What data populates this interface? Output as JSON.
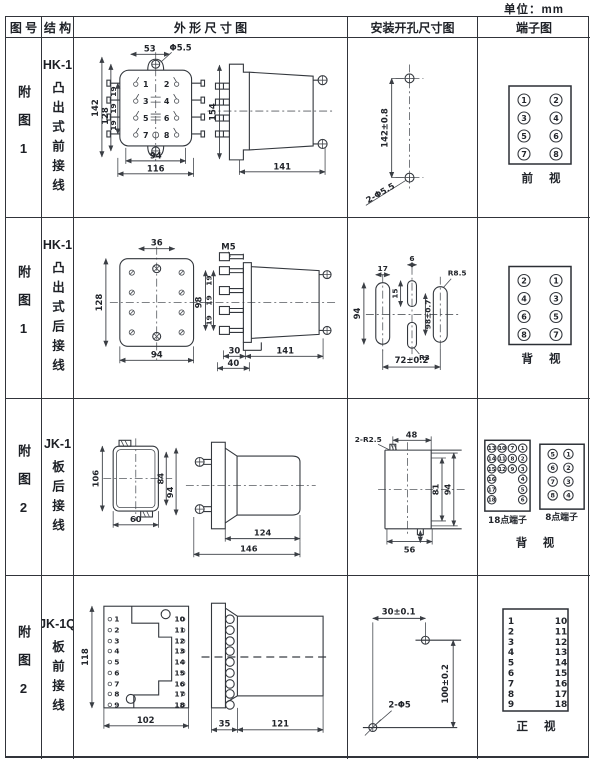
{
  "page": {
    "unit_label": "单位：mm"
  },
  "headers": {
    "fig_no": "图 号",
    "structure": "结 构",
    "outline": "外 形 尺 寸 图",
    "mounting": "安装开孔尺寸图",
    "terminal": "端子图"
  },
  "rows": [
    {
      "fig_label": "附图1",
      "model": "HK-1",
      "wiring": "凸出式前接线",
      "outline": {
        "top_width": "53",
        "hole_dia": "Φ5.5",
        "height_outer": "142",
        "height_inner": "128",
        "pitch1": "19",
        "pitch2": "19",
        "pitch3": "19",
        "bottom_inner": "94",
        "bottom_outer": "116",
        "side_height": "154",
        "side_depth": "141",
        "pins": [
          "1",
          "2",
          "3",
          "4",
          "5",
          "6",
          "7",
          "8"
        ]
      },
      "mounting": {
        "hole_pitch": "142±0.8",
        "holes": "2-Φ5.5"
      },
      "terminal": {
        "left": [
          "1",
          "3",
          "5",
          "7"
        ],
        "right": [
          "2",
          "4",
          "6",
          "8"
        ],
        "view_label": "前 视"
      }
    },
    {
      "fig_label": "附图1",
      "model": "HK-1",
      "wiring": "凸出式后接线",
      "outline": {
        "top_width": "36",
        "height": "128",
        "bottom_width": "94",
        "thread": "M5",
        "stud_span": "98",
        "pitch1": "19",
        "pitch2": "19",
        "pitch3": "19",
        "foot1": "30",
        "foot2": "40",
        "side_depth": "141"
      },
      "mounting": {
        "slot_w": "17",
        "mid_slot_w": "6",
        "mid_slot_h": "15",
        "slot_h": "94",
        "mid_pitch": "98±0.7",
        "radius_big": "R8.5",
        "radius_small": "R3",
        "h_pitch": "72±0.2"
      },
      "terminal": {
        "left": [
          "2",
          "4",
          "6",
          "8"
        ],
        "right": [
          "1",
          "3",
          "5",
          "7"
        ],
        "view_label": "背 视"
      }
    },
    {
      "fig_label": "附图2",
      "model": "JK-1",
      "wiring": "板后接线",
      "outline": {
        "height": "106",
        "inner_h": "84",
        "outer_h": "94",
        "width": "60",
        "body_len": "124",
        "total_len": "146"
      },
      "mounting": {
        "notch": "2-R2.5",
        "cut_w": "48",
        "inner_h": "81",
        "outer_h": "94",
        "cut_w2": "56"
      },
      "terminal": {
        "t18_col1": [
          "13",
          "14",
          "15",
          "16",
          "17",
          "18"
        ],
        "t18_col2": [
          "10",
          "11",
          "12"
        ],
        "t18_col3": [
          "7",
          "8",
          "9"
        ],
        "t18_col4": [
          "1",
          "2",
          "3",
          "4",
          "5",
          "6"
        ],
        "t8_left": [
          "5",
          "6",
          "7",
          "8"
        ],
        "t8_right": [
          "1",
          "2",
          "3",
          "4"
        ],
        "label18": "18点端子",
        "label8": "8点端子",
        "view_label": "背 视"
      }
    },
    {
      "fig_label": "附图2",
      "model": "JK-1Q",
      "wiring": "板前接线",
      "outline": {
        "height": "118",
        "width": "102",
        "plate_d": "35",
        "body_d": "121",
        "pins_left": [
          "1",
          "2",
          "3",
          "4",
          "5",
          "6",
          "7",
          "8",
          "9"
        ],
        "pins_right": [
          "10",
          "11",
          "12",
          "13",
          "14",
          "15",
          "16",
          "17",
          "18"
        ]
      },
      "mounting": {
        "h_pitch": "30±0.1",
        "v_pitch": "100±0.2",
        "holes": "2-Φ5"
      },
      "terminal": {
        "left": [
          "1",
          "2",
          "3",
          "4",
          "5",
          "6",
          "7",
          "8",
          "9"
        ],
        "right": [
          "10",
          "11",
          "12",
          "13",
          "14",
          "15",
          "16",
          "17",
          "18"
        ],
        "view_label": "正 视"
      }
    }
  ]
}
